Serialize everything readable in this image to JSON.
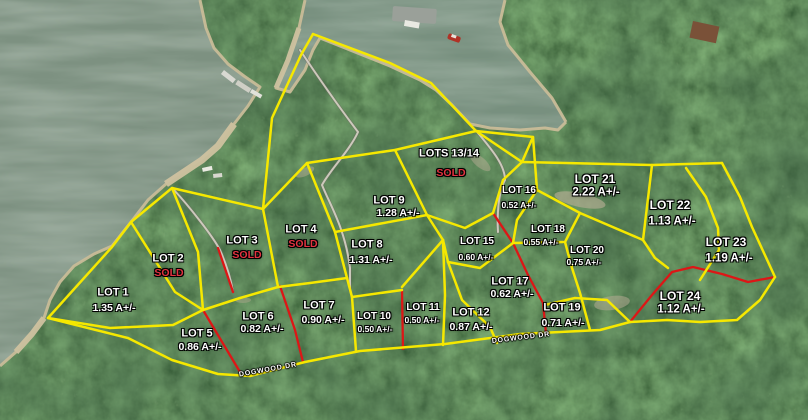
{
  "map": {
    "road": {
      "labels": [
        {
          "text": "DOGWOOD DR",
          "x": 268,
          "y": 370,
          "rot": -10
        },
        {
          "text": "DOGWOOD DR",
          "x": 521,
          "y": 338,
          "rot": -7
        }
      ]
    },
    "lots": [
      {
        "id": "1",
        "name": "LOT 1",
        "detail": "1.35 A+/-",
        "status": "available",
        "x": 113,
        "y": 293,
        "dx": 1,
        "dy": 15,
        "size": "md"
      },
      {
        "id": "2",
        "name": "LOT 2",
        "detail": "SOLD",
        "status": "sold",
        "x": 168,
        "y": 259,
        "dx": 1,
        "dy": 14,
        "size": "md"
      },
      {
        "id": "3",
        "name": "LOT 3",
        "detail": "SOLD",
        "status": "sold",
        "x": 242,
        "y": 241,
        "dx": 5,
        "dy": 14,
        "size": "md"
      },
      {
        "id": "4",
        "name": "LOT 4",
        "detail": "SOLD",
        "status": "sold",
        "x": 301,
        "y": 230,
        "dx": 2,
        "dy": 14,
        "size": "md"
      },
      {
        "id": "5",
        "name": "LOT 5",
        "detail": "0.86 A+/-",
        "status": "available",
        "x": 197,
        "y": 334,
        "dx": 3,
        "dy": 13,
        "size": "md"
      },
      {
        "id": "6",
        "name": "LOT 6",
        "detail": "0.82 A+/-",
        "status": "available",
        "x": 258,
        "y": 317,
        "dx": 4,
        "dy": 12,
        "size": "md"
      },
      {
        "id": "7",
        "name": "LOT 7",
        "detail": "0.90 A+/-",
        "status": "available",
        "x": 319,
        "y": 306,
        "dx": 4,
        "dy": 14,
        "size": "md"
      },
      {
        "id": "8",
        "name": "LOT 8",
        "detail": "1.31 A+/-",
        "status": "available",
        "x": 367,
        "y": 245,
        "dx": 4,
        "dy": 15,
        "size": "md"
      },
      {
        "id": "9",
        "name": "LOT 9",
        "detail": "1.28 A+/-",
        "status": "available",
        "x": 389,
        "y": 201,
        "dx": 9,
        "dy": 12,
        "size": "md"
      },
      {
        "id": "10",
        "name": "LOT 10",
        "detail": "0.50 A+/-",
        "status": "available",
        "x": 374,
        "y": 317,
        "dx": 1,
        "dy": 12,
        "size": "sm"
      },
      {
        "id": "11",
        "name": "LOT 11",
        "detail": "0.50 A+/-",
        "status": "available",
        "x": 423,
        "y": 308,
        "dx": -1,
        "dy": 12,
        "size": "sm"
      },
      {
        "id": "12",
        "name": "LOT 12",
        "detail": "0.87 A+/-",
        "status": "available",
        "x": 471,
        "y": 313,
        "dx": 0,
        "dy": 14,
        "size": "md"
      },
      {
        "id": "13-14",
        "name": "LOTS 13/14",
        "detail": "SOLD",
        "status": "sold",
        "x": 449,
        "y": 154,
        "dx": 2,
        "dy": 19,
        "size": "md"
      },
      {
        "id": "15",
        "name": "LOT 15",
        "detail": "0.60 A+/-",
        "status": "available",
        "x": 477,
        "y": 242,
        "dx": -1,
        "dy": 15,
        "size": "sm"
      },
      {
        "id": "16",
        "name": "LOT 16",
        "detail": "0.52 A+/-",
        "status": "available",
        "x": 519,
        "y": 191,
        "dx": 0,
        "dy": 14,
        "size": "sm"
      },
      {
        "id": "17",
        "name": "LOT 17",
        "detail": "0.62 A+/-",
        "status": "available",
        "x": 510,
        "y": 282,
        "dx": 2,
        "dy": 12,
        "size": "md"
      },
      {
        "id": "18",
        "name": "LOT 18",
        "detail": "0.55 A+/-",
        "status": "available",
        "x": 548,
        "y": 230,
        "dx": -7,
        "dy": 12,
        "size": "sm"
      },
      {
        "id": "19",
        "name": "LOT 19",
        "detail": "0.71 A+/-",
        "status": "available",
        "x": 562,
        "y": 308,
        "dx": 1,
        "dy": 15,
        "size": "md"
      },
      {
        "id": "20",
        "name": "LOT 20",
        "detail": "0.75 A+/-",
        "status": "available",
        "x": 587,
        "y": 251,
        "dx": -3,
        "dy": 11,
        "size": "sm"
      },
      {
        "id": "21",
        "name": "LOT 21",
        "detail": "2.22 A+/-",
        "status": "available",
        "x": 595,
        "y": 179,
        "dx": 1,
        "dy": 14,
        "size": "lg"
      },
      {
        "id": "22",
        "name": "LOT 22",
        "detail": "1.13 A+/-",
        "status": "available",
        "x": 670,
        "y": 205,
        "dx": 2,
        "dy": 17,
        "size": "lg"
      },
      {
        "id": "23",
        "name": "LOT 23",
        "detail": "1.19 A+/-",
        "status": "available",
        "x": 726,
        "y": 242,
        "dx": 3,
        "dy": 17,
        "size": "lg"
      },
      {
        "id": "24",
        "name": "LOT 24",
        "detail": "1.12 A+/-",
        "status": "available",
        "x": 680,
        "y": 296,
        "dx": 1,
        "dy": 14,
        "size": "lg"
      }
    ],
    "colors": {
      "lot_line": "#f6e800",
      "sold_line": "#dd1616",
      "label_text": "#ffffff",
      "sold_text": "#e23340",
      "water": "#7d9181",
      "forest": "#2f4a28",
      "sand": "#c9bc98",
      "path": "#d8d2c6"
    }
  }
}
